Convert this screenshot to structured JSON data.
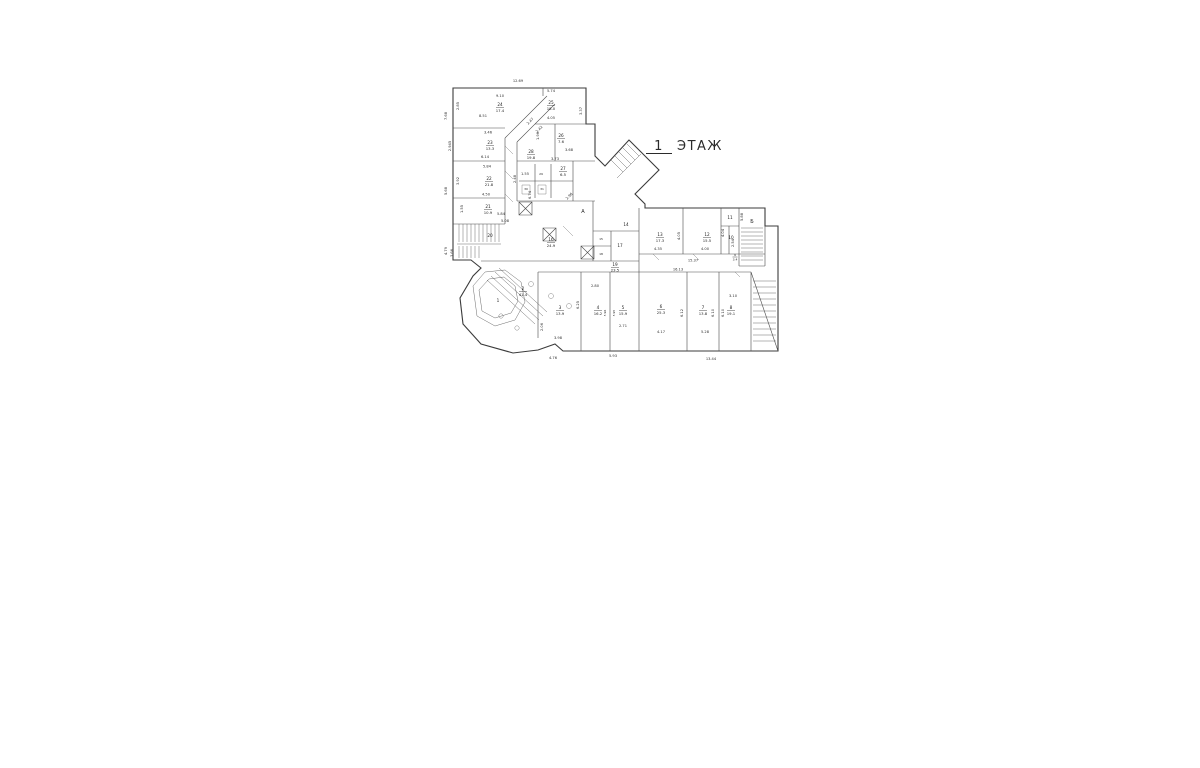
{
  "title": {
    "number": "1",
    "word": "ЭТАЖ"
  },
  "plan": {
    "rooms": [
      {
        "number": "1"
      },
      {
        "number": "2",
        "area": "41.4"
      },
      {
        "number": "3",
        "area": "13.9"
      },
      {
        "number": "4",
        "area": "16.2"
      },
      {
        "number": "5",
        "area": "15.9"
      },
      {
        "number": "6",
        "area": "25.3"
      },
      {
        "number": "7",
        "area": "13.8"
      },
      {
        "number": "8",
        "area": "19.1"
      },
      {
        "number": "9",
        "area": "3.4"
      },
      {
        "number": "10"
      },
      {
        "number": "11"
      },
      {
        "number": "12",
        "area": "15.5"
      },
      {
        "number": "13",
        "area": "17.3"
      },
      {
        "number": "14"
      },
      {
        "number": "15"
      },
      {
        "number": "16",
        "area": "24.9"
      },
      {
        "number": "17"
      },
      {
        "number": "18"
      },
      {
        "number": "19",
        "area": "23.5"
      },
      {
        "number": "20"
      },
      {
        "number": "21",
        "area": "10.9"
      },
      {
        "number": "22",
        "area": "21.8"
      },
      {
        "number": "23",
        "area": "13.3"
      },
      {
        "number": "24",
        "area": "17.4"
      },
      {
        "number": "25",
        "area": "18.0"
      },
      {
        "number": "26",
        "area": "7.6"
      },
      {
        "number": "27",
        "area": "6.5"
      },
      {
        "number": "28",
        "area": "19.8"
      },
      {
        "number": "29"
      },
      {
        "number": "30"
      },
      {
        "number": "31"
      }
    ],
    "stairs": [
      {
        "label": "А"
      },
      {
        "label": "Б"
      }
    ],
    "dims": [
      {
        "v": "12.69"
      },
      {
        "v": "9.10"
      },
      {
        "v": "2.85"
      },
      {
        "v": "8.51"
      },
      {
        "v": "7.68"
      },
      {
        "v": "2.945"
      },
      {
        "v": "3.46"
      },
      {
        "v": "6.14"
      },
      {
        "v": "5.84"
      },
      {
        "v": "3.92"
      },
      {
        "v": "2.48"
      },
      {
        "v": "4.50"
      },
      {
        "v": "1.55"
      },
      {
        "v": "5.84"
      },
      {
        "v": "5.68"
      },
      {
        "v": "5.08"
      },
      {
        "v": "4.79"
      },
      {
        "v": "3.66"
      },
      {
        "v": "2.47"
      },
      {
        "v": "2.42"
      },
      {
        "v": "5.74"
      },
      {
        "v": "4.05"
      },
      {
        "v": "3.37"
      },
      {
        "v": "1.96"
      },
      {
        "v": "3.68"
      },
      {
        "v": "3.73"
      },
      {
        "v": "1.55"
      },
      {
        "v": "6.74"
      },
      {
        "v": "2.96"
      },
      {
        "v": "4.35"
      },
      {
        "v": "4.05"
      },
      {
        "v": "4.00"
      },
      {
        "v": "4.04"
      },
      {
        "v": "15.37"
      },
      {
        "v": "16.13"
      },
      {
        "v": "5.88"
      },
      {
        "v": "2.54"
      },
      {
        "v": "2.80"
      },
      {
        "v": "6.25"
      },
      {
        "v": "5.96"
      },
      {
        "v": "5.95"
      },
      {
        "v": "2.71"
      },
      {
        "v": "5.93"
      },
      {
        "v": "6.12"
      },
      {
        "v": "4.17"
      },
      {
        "v": "6.10"
      },
      {
        "v": "6.10"
      },
      {
        "v": "3.10"
      },
      {
        "v": "5.28"
      },
      {
        "v": "13.44"
      },
      {
        "v": "2.06"
      },
      {
        "v": "3.98"
      },
      {
        "v": "4.76"
      }
    ]
  }
}
